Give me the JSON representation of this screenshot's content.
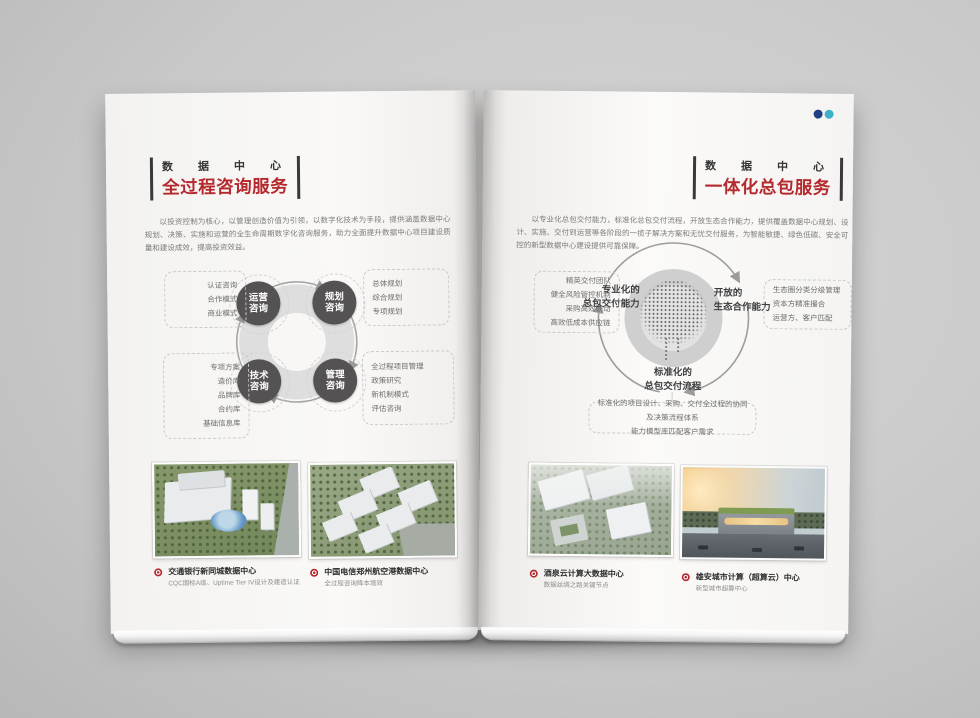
{
  "left": {
    "eyebrow": "数据中心",
    "title": "全过程咨询服务",
    "intro": "以投资控制为核心，以管理创造价值为引领，以数字化技术为手段，提供涵盖数据中心规划、决策、实施和运营的全生命周期数字化咨询服务，助力全面提升数据中心项目建设质量和建设成效，提高投资效益。",
    "nodes": [
      "运营咨询",
      "规划咨询",
      "技术咨询",
      "管理咨询"
    ],
    "boxes": {
      "top_left": [
        "认证咨询",
        "合作模式",
        "商业模式"
      ],
      "top_right": [
        "总体规划",
        "综合规划",
        "专项规划"
      ],
      "bottom_left": [
        "专项方案",
        "造价库",
        "品牌库",
        "合约库",
        "基础信息库"
      ],
      "bottom_right": [
        "全过程项目管理",
        "政策研究",
        "新机制模式",
        "评估咨询"
      ]
    },
    "cases": [
      {
        "title": "交通银行新同城数据中心",
        "desc": "CQC国标A级、Uptime Tier IV设计及建造认证"
      },
      {
        "title": "中国电信郑州航空港数据中心",
        "desc": "全过程咨询降本增效"
      }
    ]
  },
  "right": {
    "eyebrow": "数据中心",
    "title": "一体化总包服务",
    "intro": "以专业化总包交付能力，标准化总包交付流程，开放生态合作能力，提供覆盖数据中心规划、设计、实施、交付到运营等各阶段的一揽子解决方案和无忧交付服务，为智能敏捷、绿色低碳、安全可控的新型数据中心建设提供可靠保障。",
    "labels": {
      "left": [
        "专业化的",
        "总包交付能力"
      ],
      "right": [
        "开放的",
        "生态合作能力"
      ],
      "bottom": [
        "标准化的",
        "总包交付流程"
      ]
    },
    "boxes": {
      "left": [
        "精英交付团队",
        "健全风险管控机制",
        "采购高效联动",
        "高效低成本供应链"
      ],
      "right": [
        "生态圈分类分级管理",
        "资本方精准撮合",
        "运营方、客户匹配"
      ],
      "bottom": [
        "标准化的项目设计、采购、交付全过程的协同及决策流程体系",
        "能力模型库匹配客户需求"
      ]
    },
    "cases": [
      {
        "title": "酒泉云计算大数据中心",
        "desc": "数据丝绸之路关键节点"
      },
      {
        "title": "雄安城市计算（超算云）中心",
        "desc": "新型城市超算中心"
      }
    ]
  },
  "colors": {
    "accent": "#b4292d",
    "node": "#555254"
  }
}
